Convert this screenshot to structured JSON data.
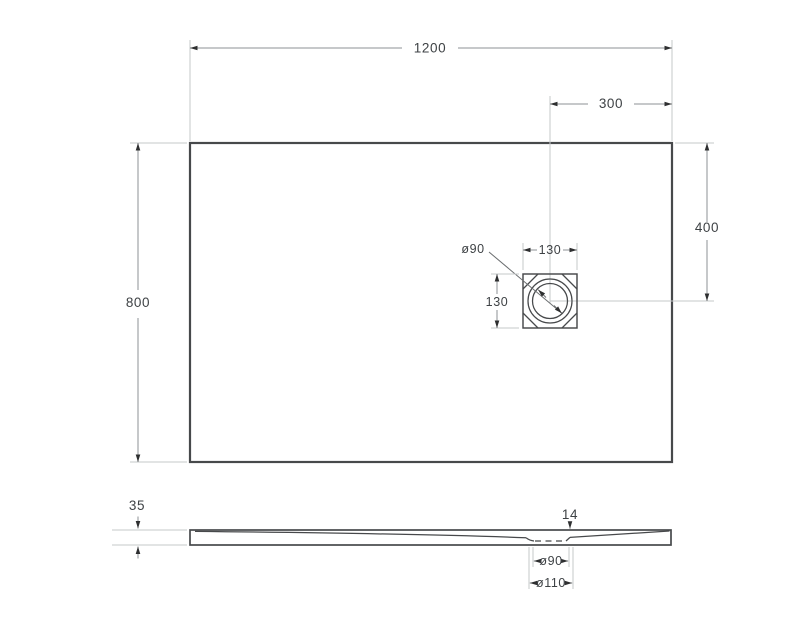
{
  "colors": {
    "background": "#ffffff",
    "outline": "#47494b",
    "dim": "#8e9295",
    "ext": "#c5c8ca",
    "arrow": "#2e2f30",
    "text": "#3e4245",
    "leader": "#6b6e70"
  },
  "top_view": {
    "overall_width_mm": "1200",
    "overall_depth_mm": "800",
    "drain_offset_from_right_mm": "300",
    "drain_offset_from_top_mm": "400",
    "drain_flange_width_mm": "130",
    "drain_flange_height_mm": "130",
    "drain_hole_diameter": "ø90"
  },
  "side_view": {
    "edge_height_mm": "35",
    "drain_zone_height_mm": "14",
    "drain_hole_diameter": "ø90",
    "drain_recess_diameter": "ø110"
  }
}
